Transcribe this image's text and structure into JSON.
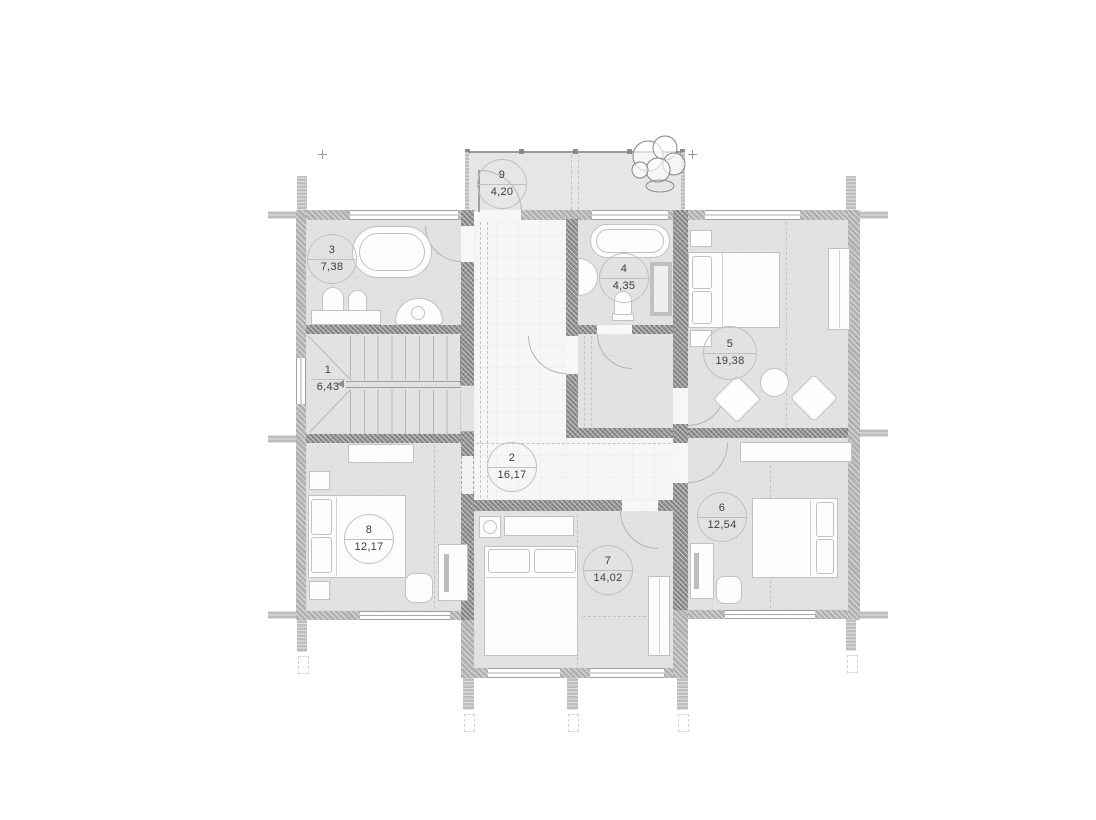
{
  "plan_title": "second-floor-plan",
  "rooms": {
    "r1": {
      "number": "1",
      "area": "6,43",
      "type": "stairs"
    },
    "r2": {
      "number": "2",
      "area": "16,17",
      "type": "hall"
    },
    "r3": {
      "number": "3",
      "area": "7,38",
      "type": "bathroom"
    },
    "r4": {
      "number": "4",
      "area": "4,35",
      "type": "bathroom"
    },
    "r5": {
      "number": "5",
      "area": "19,38",
      "type": "bedroom"
    },
    "r6": {
      "number": "6",
      "area": "12,54",
      "type": "bedroom"
    },
    "r7": {
      "number": "7",
      "area": "14,02",
      "type": "bedroom"
    },
    "r8": {
      "number": "8",
      "area": "12,17",
      "type": "bedroom"
    },
    "r9": {
      "number": "9",
      "area": "4,20",
      "type": "balcony"
    }
  },
  "colors": {
    "room_fill": "#e2e2e2",
    "hall_fill": "#f6f6f6",
    "wall_exterior": "#b1b1b1",
    "wall_interior": "#8f8f8f",
    "furniture_outline": "#c2c2c2",
    "label_text": "#3c3c3c"
  }
}
